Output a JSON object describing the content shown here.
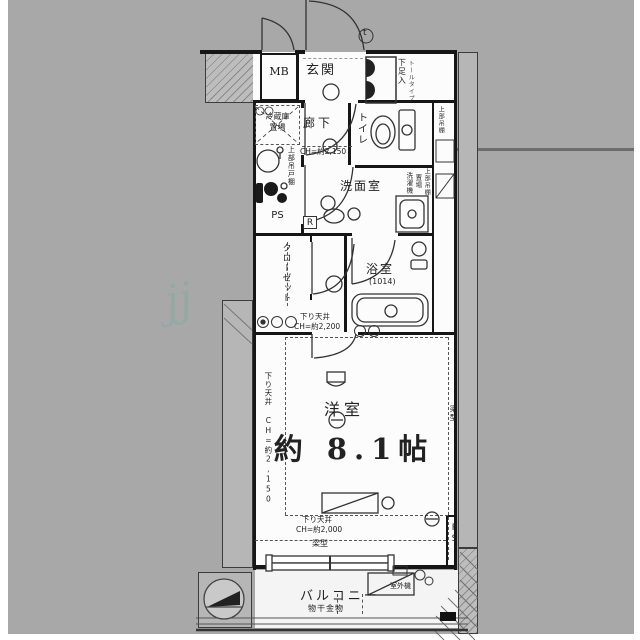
{
  "plan_title": "floor-plan",
  "colors": {
    "background": "#a8a8a8",
    "wall": "#161616",
    "floor": "#fcfcfc",
    "band": "#b6b6b6",
    "watermark": "#6fae9e"
  },
  "rooms": {
    "mb": {
      "label": "MB"
    },
    "entrance": {
      "label": "玄関",
      "shoe": "下足入",
      "shoe_sub": "トールタイプ",
      "door_mark": "t"
    },
    "kitchen": {
      "fridge1": "冷蔵庫",
      "fridge2": "置場",
      "cabinet": "上部吊戸棚",
      "ps": "PS"
    },
    "hallway": {
      "label": "廊下",
      "ch": "CH=約2,150"
    },
    "toilet": {
      "label": "トイレ",
      "shelf": "上部吊棚"
    },
    "washroom": {
      "label": "洗面室",
      "washer1": "洗濯機",
      "washer2": "置場",
      "shelf": "上部吊棚",
      "r": "R"
    },
    "closet": {
      "label": "クローゼット"
    },
    "bath": {
      "label": "浴室",
      "size": "(1014)"
    },
    "drop1": {
      "line1": "下り天井",
      "line2": "CH=約2,200"
    },
    "main": {
      "label": "洋室",
      "size": "約 8.1帖",
      "left_drop": "下り天井 CH=約2,150",
      "beam": "梁型"
    },
    "drop2": {
      "line1": "下り天井",
      "line2": "CH=約2,000",
      "beam": "梁型",
      "ps": "PS"
    },
    "balcony": {
      "label": "バルコニー",
      "ac": "室外機",
      "hook": "物干金物"
    }
  },
  "watermark": "jj"
}
